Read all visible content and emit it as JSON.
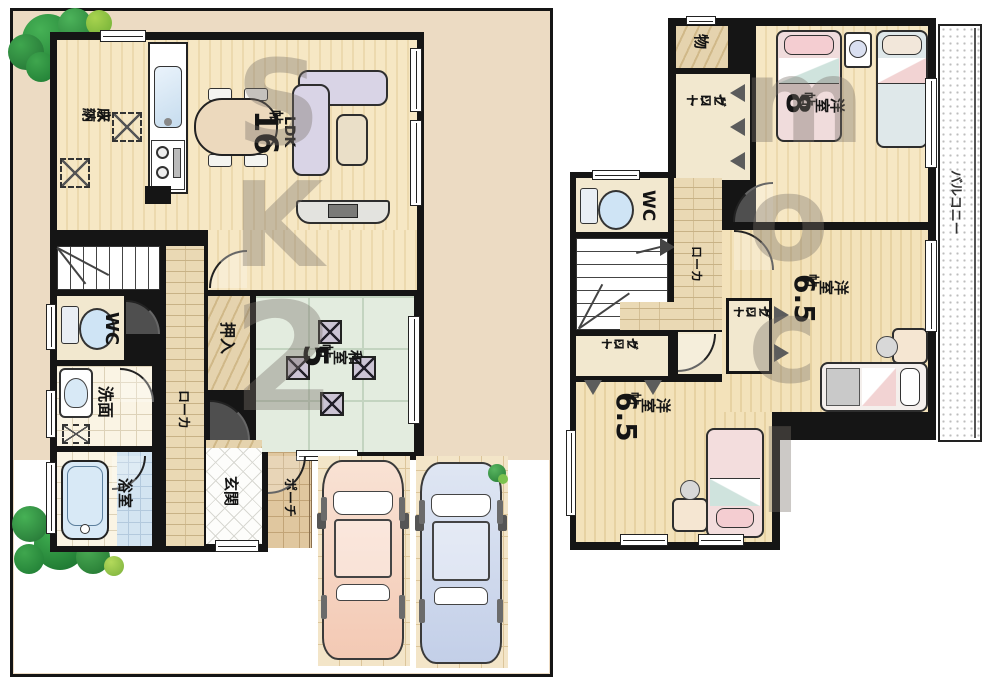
{
  "floor1": {
    "kitchen_storage_l1": "床下",
    "kitchen_storage_l2": "収納",
    "ldk_name": "LDK",
    "ldk_size_num": "16",
    "ldk_size_unit": "帖",
    "oshiire": "押入",
    "washitsu_name": "和室",
    "washitsu_size_num": "5",
    "washitsu_size_unit": "帖",
    "wc": "WC",
    "senmen": "洗面",
    "bath": "浴室",
    "hallway": "ローカ",
    "genkan": "玄関",
    "porch": "ポーチ"
  },
  "floor2": {
    "storage": "物",
    "closet_l1": "クロー",
    "closet_l2": "ゼット",
    "room8_name": "洋室",
    "room8_size_num": "8",
    "room8_size_unit": "帖",
    "wc": "WC",
    "hallway": "ローカ",
    "room65_name": "洋室",
    "room65_size_num": "6.5",
    "room65_size_unit": "帖",
    "balcony": "バルコニー"
  },
  "watermark": {
    "left": [
      "S",
      "K",
      "2"
    ],
    "right": [
      "m",
      "o",
      "c",
      "I"
    ]
  },
  "colors": {
    "site_ground": "#ecdbc3",
    "wood_floor": "#f6e7c4",
    "tatami_green": "#e3ecdf",
    "hallway_brick": "#ead9b4",
    "cushion_purple": "#cbc3d4",
    "car_pink": "#f6d4c2",
    "car_blue": "#ccd7eb",
    "tree_green": "#2d8f3f",
    "water_blue": "#d8e9f6",
    "watermark_gray": "#78726a"
  }
}
